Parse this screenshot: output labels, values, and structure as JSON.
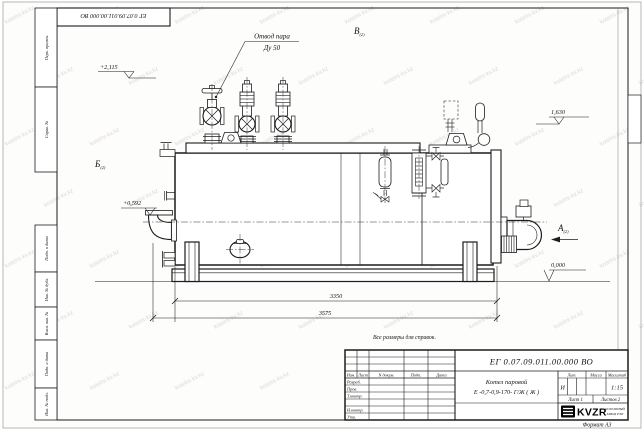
{
  "watermark": {
    "text": "kotelni-kv.kz"
  },
  "sheet": {
    "designation_stamp": "ЕГ 0.07.09.011.00.000  ВО",
    "format_label": "Формат А3",
    "side_labels": [
      "Перв. примен.",
      "Справ. №",
      "Подп. и дата",
      "Инв. № дубл.",
      "Взам. инв. №",
      "Подп. и дата",
      "Инв. № подл."
    ]
  },
  "drawing": {
    "note": "Все размеры для справок.",
    "leader": {
      "line1": "Отвод пара",
      "line2": "Ду 50"
    },
    "views": {
      "a": "А",
      "b": "Б",
      "v": "В",
      "sub": "(2)"
    },
    "elevations": {
      "top": "+2,115",
      "right": "1,630",
      "left": "+0,592",
      "ground": "0,000"
    },
    "dimensions": {
      "inner": "3350",
      "overall": "3575"
    }
  },
  "title_block": {
    "designation": "ЕГ 0.07.09.011.00.000  ВО",
    "product_name": "Котел паровой",
    "product_type": "Е -0,7-0,9-170- Г/Ж ( Ж )",
    "columns": {
      "izm": "Изм.",
      "list": "Лист",
      "doc": "N докум.",
      "sign": "Подп.",
      "date": "Дата"
    },
    "rows": {
      "dev": "Разраб.",
      "check": "Пров.",
      "tcontr": "Т.контр.",
      "ncontr": "Н.контр.",
      "approve": "Утв."
    },
    "lit_label": "Лит.",
    "mass_label": "Масса",
    "scale_label": "Масштаб",
    "lit_value": "И",
    "scale_value": "1:15",
    "sheet_info": "Лист 1",
    "sheets_info": "Листов 2",
    "logo": {
      "text": "KVZR",
      "sub1": "КОТЕЛЬНЫЙ",
      "sub2": "ЗАВОД РЭП"
    }
  }
}
